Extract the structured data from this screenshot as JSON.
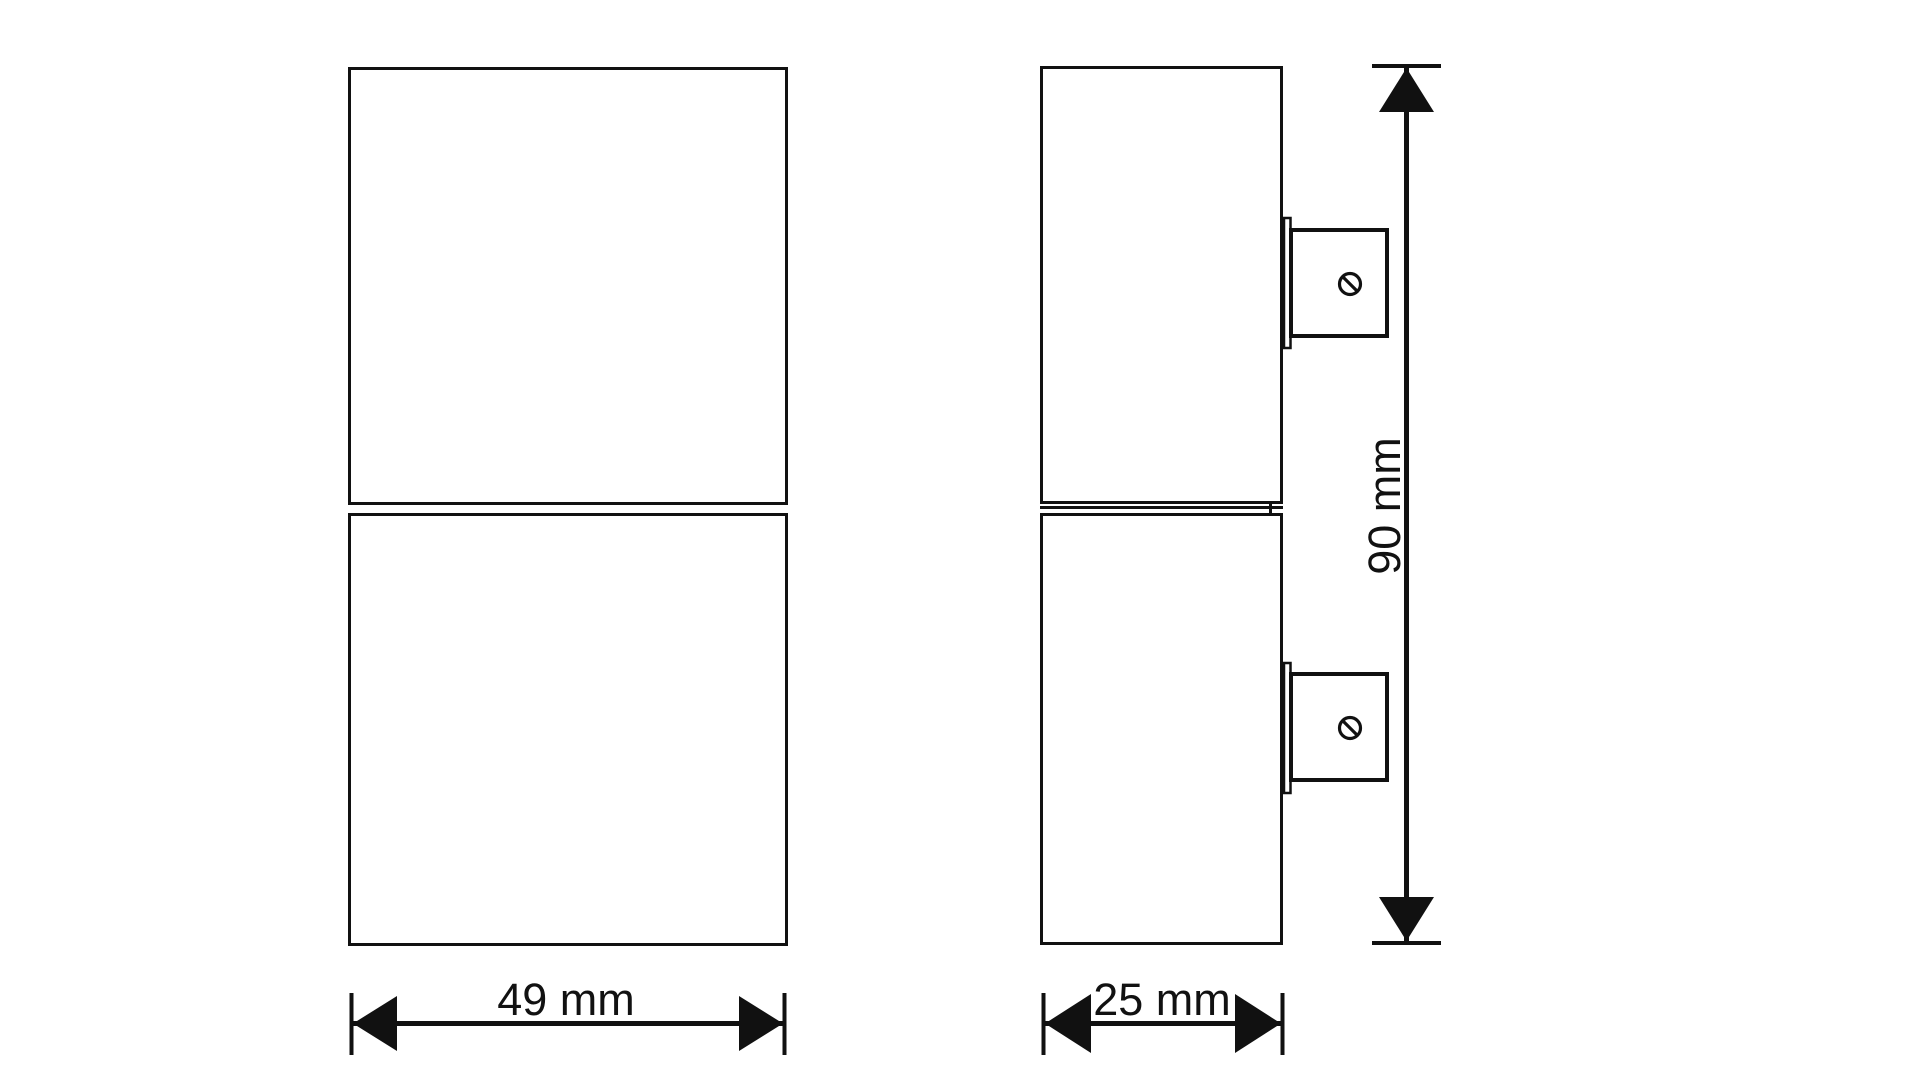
{
  "canvas": {
    "background": "#ffffff",
    "line_color": "#111111"
  },
  "dimensions": {
    "front_width": {
      "label": "49 mm",
      "value": "49",
      "unit": "mm"
    },
    "side_depth": {
      "label": "25 mm",
      "value": "25",
      "unit": "mm"
    },
    "side_height": {
      "label": "90 mm",
      "value": "90",
      "unit": "mm"
    }
  }
}
